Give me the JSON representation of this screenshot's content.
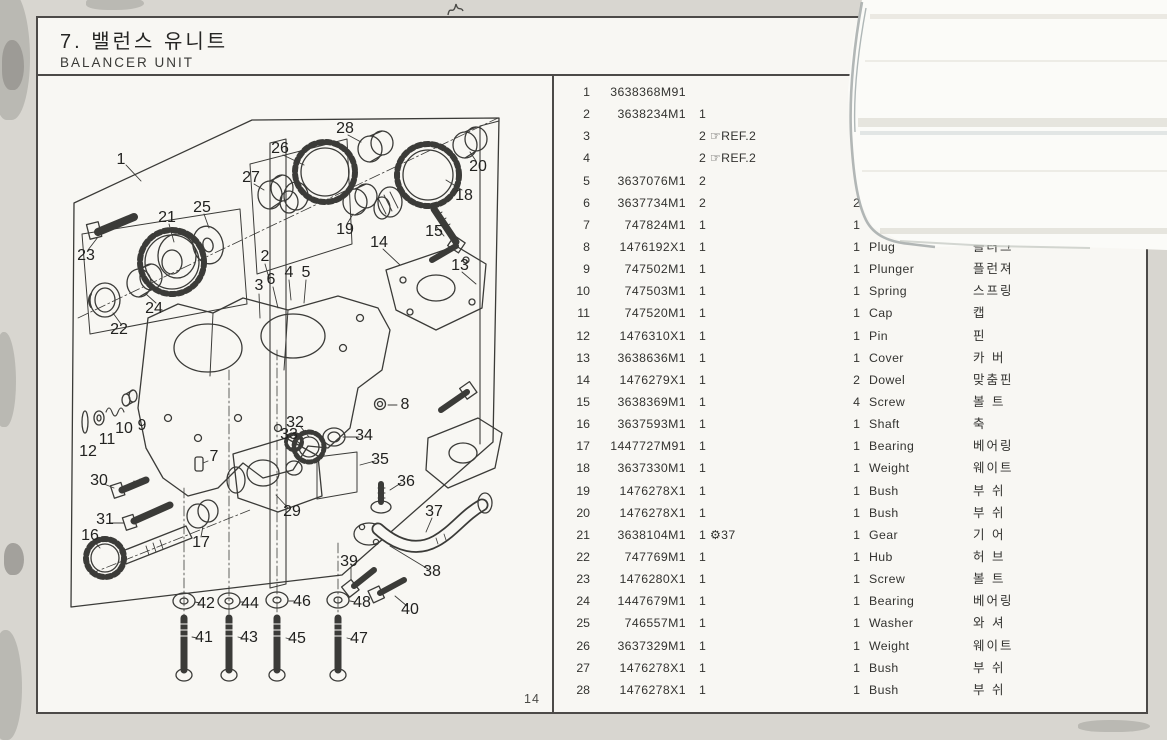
{
  "page": {
    "title_kr": "7. 밸런스 유니트",
    "title_en": "BALANCER UNIT",
    "page_number": "14"
  },
  "table": {
    "rows": [
      {
        "no": "1",
        "part": "3638368M91",
        "qty": "",
        "note": "",
        "qty2": "",
        "name": "",
        "kr": ""
      },
      {
        "no": "2",
        "part": "3638234M1",
        "qty": "1",
        "note": "",
        "qty2": "",
        "name": "",
        "kr": ""
      },
      {
        "no": "3",
        "part": "",
        "qty": "2",
        "note": "☞REF.2",
        "qty2": "",
        "name": "",
        "kr": ""
      },
      {
        "no": "4",
        "part": "",
        "qty": "2",
        "note": "☞REF.2",
        "qty2": "",
        "name": "",
        "kr": ""
      },
      {
        "no": "5",
        "part": "3637076M1",
        "qty": "2",
        "note": "",
        "qty2": "",
        "name": "",
        "kr": ""
      },
      {
        "no": "6",
        "part": "3637734M1",
        "qty": "2",
        "note": "",
        "qty2": "2",
        "name": "",
        "kr": ""
      },
      {
        "no": "7",
        "part": "747824M1",
        "qty": "1",
        "note": "",
        "qty2": "1",
        "name": "",
        "kr": ""
      },
      {
        "no": "8",
        "part": "1476192X1",
        "qty": "1",
        "note": "",
        "qty2": "1",
        "name": "Plug",
        "kr": "플러그"
      },
      {
        "no": "9",
        "part": "747502M1",
        "qty": "1",
        "note": "",
        "qty2": "1",
        "name": "Plunger",
        "kr": "플런져"
      },
      {
        "no": "10",
        "part": "747503M1",
        "qty": "1",
        "note": "",
        "qty2": "1",
        "name": "Spring",
        "kr": "스프링"
      },
      {
        "no": "11",
        "part": "747520M1",
        "qty": "1",
        "note": "",
        "qty2": "1",
        "name": "Cap",
        "kr": "캡"
      },
      {
        "no": "12",
        "part": "1476310X1",
        "qty": "1",
        "note": "",
        "qty2": "1",
        "name": "Pin",
        "kr": "핀"
      },
      {
        "no": "13",
        "part": "3638636M1",
        "qty": "1",
        "note": "",
        "qty2": "1",
        "name": "Cover",
        "kr": "카 버"
      },
      {
        "no": "14",
        "part": "1476279X1",
        "qty": "1",
        "note": "",
        "qty2": "2",
        "name": "Dowel",
        "kr": "맞춤핀"
      },
      {
        "no": "15",
        "part": "3638369M1",
        "qty": "1",
        "note": "",
        "qty2": "4",
        "name": "Screw",
        "kr": "볼 트"
      },
      {
        "no": "16",
        "part": "3637593M1",
        "qty": "1",
        "note": "",
        "qty2": "1",
        "name": "Shaft",
        "kr": "축"
      },
      {
        "no": "17",
        "part": "1447727M91",
        "qty": "1",
        "note": "",
        "qty2": "1",
        "name": "Bearing",
        "kr": "베어링"
      },
      {
        "no": "18",
        "part": "3637330M1",
        "qty": "1",
        "note": "",
        "qty2": "1",
        "name": "Weight",
        "kr": "웨이트"
      },
      {
        "no": "19",
        "part": "1476278X1",
        "qty": "1",
        "note": "",
        "qty2": "1",
        "name": "Bush",
        "kr": "부 쉬"
      },
      {
        "no": "20",
        "part": "1476278X1",
        "qty": "1",
        "note": "",
        "qty2": "1",
        "name": "Bush",
        "kr": "부 쉬"
      },
      {
        "no": "21",
        "part": "3638104M1",
        "qty": "1",
        "note": "⚙37",
        "qty2": "1",
        "name": "Gear",
        "kr": "기 어"
      },
      {
        "no": "22",
        "part": "747769M1",
        "qty": "1",
        "note": "",
        "qty2": "1",
        "name": "Hub",
        "kr": "허 브"
      },
      {
        "no": "23",
        "part": "1476280X1",
        "qty": "1",
        "note": "",
        "qty2": "1",
        "name": "Screw",
        "kr": "볼 트"
      },
      {
        "no": "24",
        "part": "1447679M1",
        "qty": "1",
        "note": "",
        "qty2": "1",
        "name": "Bearing",
        "kr": "베어링"
      },
      {
        "no": "25",
        "part": "746557M1",
        "qty": "1",
        "note": "",
        "qty2": "1",
        "name": "Washer",
        "kr": "와 셔"
      },
      {
        "no": "26",
        "part": "3637329M1",
        "qty": "1",
        "note": "",
        "qty2": "1",
        "name": "Weight",
        "kr": "웨이트"
      },
      {
        "no": "27",
        "part": "1476278X1",
        "qty": "1",
        "note": "",
        "qty2": "1",
        "name": "Bush",
        "kr": "부 쉬"
      },
      {
        "no": "28",
        "part": "1476278X1",
        "qty": "1",
        "note": "",
        "qty2": "1",
        "name": "Bush",
        "kr": "부 쉬"
      }
    ]
  },
  "diagram": {
    "callouts": [
      {
        "n": "1",
        "x": 83,
        "y": 142
      },
      {
        "n": "2",
        "x": 227,
        "y": 239
      },
      {
        "n": "3",
        "x": 221,
        "y": 268
      },
      {
        "n": "4",
        "x": 251,
        "y": 255
      },
      {
        "n": "5",
        "x": 268,
        "y": 255
      },
      {
        "n": "6",
        "x": 233,
        "y": 262
      },
      {
        "n": "7",
        "x": 176,
        "y": 439
      },
      {
        "n": "8",
        "x": 367,
        "y": 387
      },
      {
        "n": "9",
        "x": 104,
        "y": 408
      },
      {
        "n": "10",
        "x": 86,
        "y": 411
      },
      {
        "n": "11",
        "x": 69,
        "y": 422
      },
      {
        "n": "12",
        "x": 50,
        "y": 434
      },
      {
        "n": "13",
        "x": 422,
        "y": 248
      },
      {
        "n": "14",
        "x": 341,
        "y": 225
      },
      {
        "n": "15",
        "x": 396,
        "y": 214
      },
      {
        "n": "16",
        "x": 52,
        "y": 518
      },
      {
        "n": "17",
        "x": 163,
        "y": 525
      },
      {
        "n": "18",
        "x": 426,
        "y": 178
      },
      {
        "n": "19",
        "x": 307,
        "y": 212
      },
      {
        "n": "20",
        "x": 440,
        "y": 149
      },
      {
        "n": "21",
        "x": 129,
        "y": 200
      },
      {
        "n": "22",
        "x": 81,
        "y": 312
      },
      {
        "n": "23",
        "x": 48,
        "y": 238
      },
      {
        "n": "24",
        "x": 116,
        "y": 291
      },
      {
        "n": "25",
        "x": 164,
        "y": 190
      },
      {
        "n": "26",
        "x": 242,
        "y": 131
      },
      {
        "n": "27",
        "x": 213,
        "y": 160
      },
      {
        "n": "28",
        "x": 307,
        "y": 111
      },
      {
        "n": "29",
        "x": 254,
        "y": 494
      },
      {
        "n": "30",
        "x": 61,
        "y": 463
      },
      {
        "n": "31",
        "x": 67,
        "y": 502
      },
      {
        "n": "32",
        "x": 257,
        "y": 405
      },
      {
        "n": "33",
        "x": 251,
        "y": 417
      },
      {
        "n": "34",
        "x": 326,
        "y": 418
      },
      {
        "n": "35",
        "x": 342,
        "y": 442
      },
      {
        "n": "36",
        "x": 368,
        "y": 464
      },
      {
        "n": "37",
        "x": 396,
        "y": 494
      },
      {
        "n": "38",
        "x": 394,
        "y": 554
      },
      {
        "n": "39",
        "x": 311,
        "y": 544
      },
      {
        "n": "40",
        "x": 372,
        "y": 592
      },
      {
        "n": "41",
        "x": 166,
        "y": 620
      },
      {
        "n": "42",
        "x": 168,
        "y": 586
      },
      {
        "n": "43",
        "x": 211,
        "y": 620
      },
      {
        "n": "44",
        "x": 212,
        "y": 586
      },
      {
        "n": "45",
        "x": 259,
        "y": 621
      },
      {
        "n": "46",
        "x": 264,
        "y": 584
      },
      {
        "n": "47",
        "x": 321,
        "y": 621
      },
      {
        "n": "48",
        "x": 324,
        "y": 585
      }
    ]
  }
}
